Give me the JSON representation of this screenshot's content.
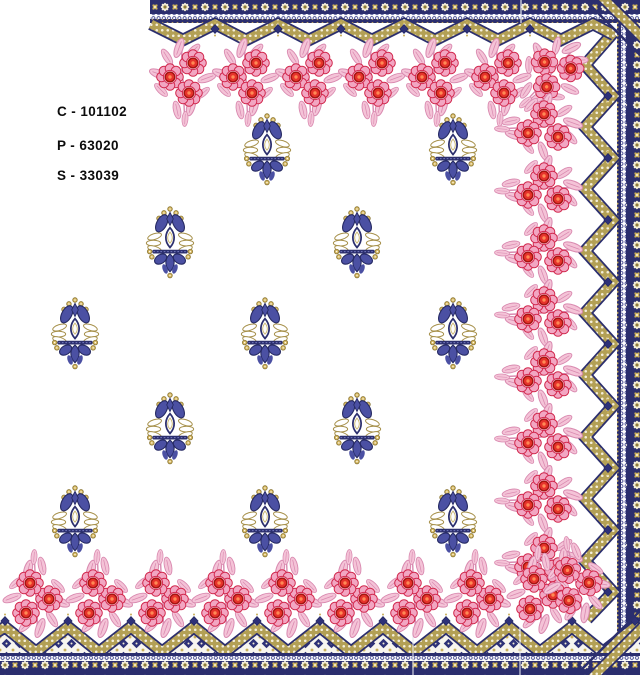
{
  "design_labels": {
    "c": "C - 101102",
    "p": "P - 63020",
    "s": "S - 33039"
  },
  "palette": {
    "background": "#ffffff",
    "border_navy": "#2b2e6e",
    "border_navy_dark": "#23265e",
    "motif_blue": "#4b50a3",
    "motif_blue_dark": "#262a63",
    "gold": "#b3a055",
    "gold_bead": "#d4b55e",
    "gold_dark": "#8c7838",
    "cream": "#f2ecd4",
    "pink": "#f2a6c2",
    "light_pink": "#f4c3d7",
    "crimson": "#d22b50",
    "red": "#e5332b",
    "dark_red": "#a31410",
    "orange_core": "#ff8a55"
  },
  "pattern": {
    "stamps": [
      {
        "name": "butta-motif",
        "href": "#butta",
        "target": "#g-motifs",
        "scale": 1.1,
        "positions": [
          [
            267,
            149
          ],
          [
            453,
            149
          ],
          [
            170,
            242
          ],
          [
            357,
            242
          ],
          [
            75,
            333
          ],
          [
            265,
            333
          ],
          [
            453,
            333
          ],
          [
            170,
            428
          ],
          [
            357,
            428
          ],
          [
            75,
            521
          ],
          [
            265,
            521
          ],
          [
            453,
            521
          ]
        ]
      },
      {
        "name": "floral-cluster",
        "href": "#cluster",
        "target": "#g-top-garland",
        "scale": 1,
        "positions": [
          [
            183,
            78
          ],
          [
            246,
            78
          ],
          [
            309,
            78
          ],
          [
            372,
            78
          ],
          [
            435,
            78
          ],
          [
            498,
            78
          ],
          [
            553,
            72,
            45
          ]
        ]
      },
      {
        "name": "floral-cluster",
        "href": "#cluster",
        "target": "#g-right-garland",
        "scale": 1,
        "positions": [
          [
            543,
            127,
            90
          ],
          [
            543,
            189,
            90
          ],
          [
            543,
            251,
            90
          ],
          [
            543,
            313,
            90
          ],
          [
            543,
            375,
            90
          ],
          [
            543,
            437,
            90
          ],
          [
            543,
            499,
            90
          ],
          [
            543,
            561,
            90
          ]
        ]
      },
      {
        "name": "floral-cluster",
        "href": "#cluster",
        "target": "#g-bottom-garland",
        "scale": 1,
        "positions": [
          [
            36,
            598,
            180
          ],
          [
            99,
            598,
            180
          ],
          [
            162,
            598,
            180
          ],
          [
            225,
            598,
            180
          ],
          [
            288,
            598,
            180
          ],
          [
            351,
            598,
            180
          ],
          [
            414,
            598,
            180
          ],
          [
            477,
            598,
            180
          ],
          [
            540,
            594,
            180
          ],
          [
            576,
            584,
            170
          ]
        ]
      },
      {
        "name": "pendant-diamond",
        "href": "#pendant",
        "target": "#g-top-pendants",
        "scale": 1,
        "positions": [
          [
            215,
            29
          ],
          [
            278,
            29
          ],
          [
            341,
            29
          ],
          [
            404,
            29
          ],
          [
            467,
            29
          ],
          [
            530,
            29
          ]
        ]
      },
      {
        "name": "pendant-diamond",
        "href": "#pendant",
        "target": "#g-right-pendants",
        "scale": 1,
        "positions": [
          [
            608,
            96
          ],
          [
            608,
            158
          ],
          [
            608,
            220
          ],
          [
            608,
            282
          ],
          [
            608,
            344
          ],
          [
            608,
            406
          ],
          [
            608,
            468
          ],
          [
            608,
            530
          ],
          [
            608,
            592
          ]
        ]
      },
      {
        "name": "pendant-diamond",
        "href": "#pendant",
        "target": "#g-bottom-pendants",
        "scale": 1,
        "positions": [
          [
            5,
            621
          ],
          [
            68,
            621
          ],
          [
            131,
            621
          ],
          [
            194,
            621
          ],
          [
            257,
            621
          ],
          [
            320,
            621
          ],
          [
            383,
            621
          ],
          [
            446,
            621
          ],
          [
            509,
            621
          ],
          [
            572,
            621
          ],
          [
            635,
            621
          ]
        ]
      }
    ]
  }
}
